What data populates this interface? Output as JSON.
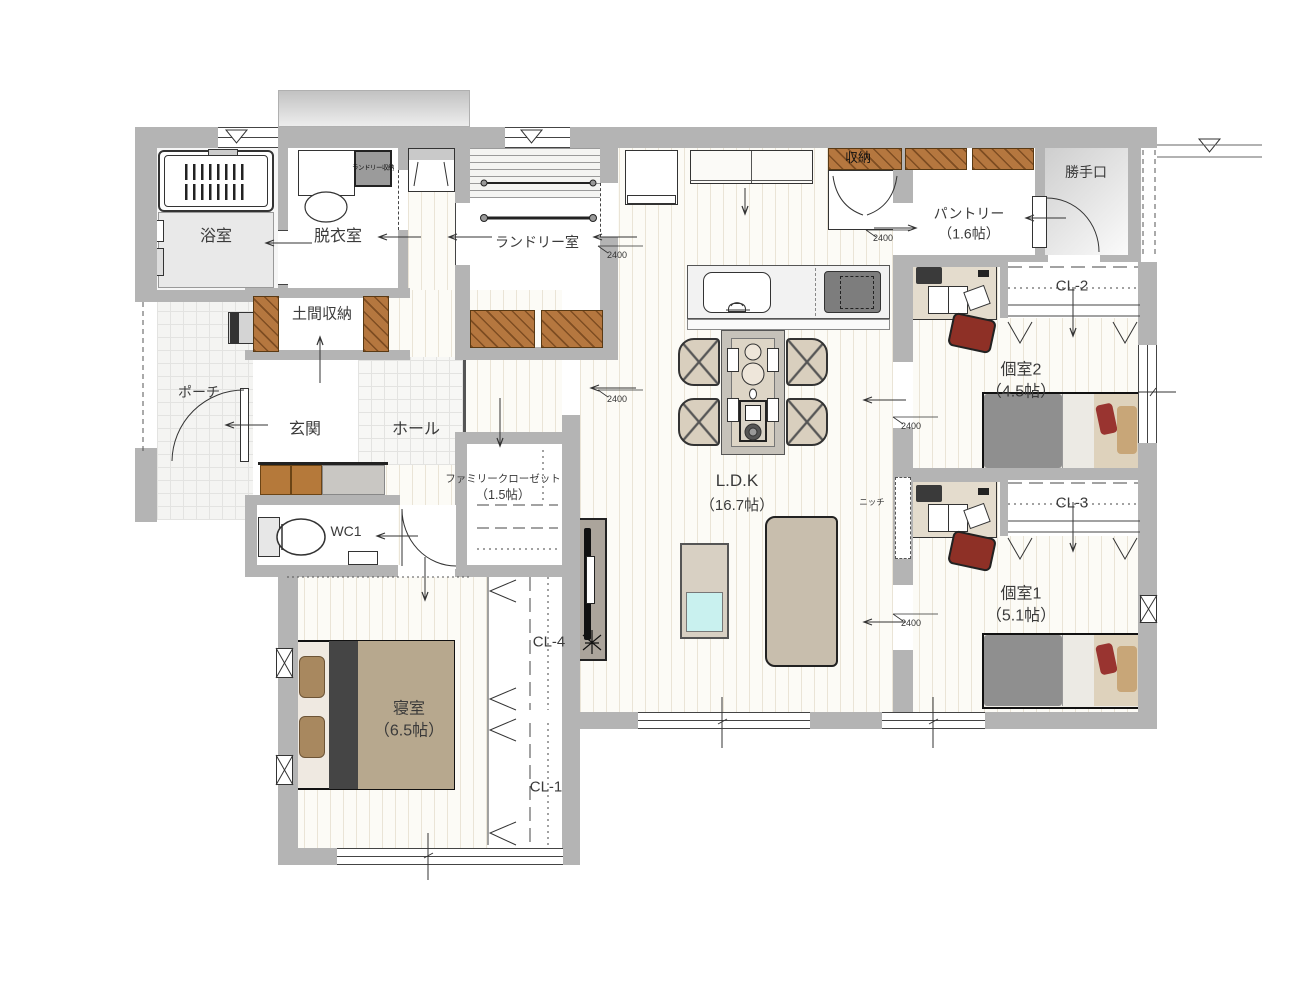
{
  "rooms": {
    "bath": "浴室",
    "dressing": "脱衣室",
    "laundry_storage": "ランドリー収納",
    "laundry": "ランドリー室",
    "storage_top": "収納",
    "pantry_name": "パントリー",
    "pantry_size": "（1.6帖）",
    "back_door": "勝手口",
    "cl2": "CL-2",
    "room2_name": "個室2",
    "room2_size": "（4.5帖）",
    "cl3": "CL-3",
    "room1_name": "個室1",
    "room1_size": "（5.1帖）",
    "doma_storage": "土間収納",
    "porch": "ポーチ",
    "entrance": "玄関",
    "hall": "ホール",
    "family_closet_name": "ファミリークローゼット",
    "family_closet_size": "（1.5帖）",
    "wc": "WC1",
    "ldk_name": "L.D.K",
    "ldk_size": "（16.7帖）",
    "niche": "ニッチ",
    "cl4": "CL-4",
    "cl1": "CL-1",
    "bedroom_name": "寝室",
    "bedroom_size": "（6.5帖）"
  },
  "dimensions": [
    "2400",
    "2400",
    "2400",
    "2400",
    "2400"
  ],
  "colors": {
    "wall": "#b4b4b4",
    "hatch_wood": "#b5773f",
    "bed_blanket": "#8f8f8f",
    "accent_red": "#8e3026",
    "tatami_beige": "#d9cfbe",
    "table_cyan": "#c9f1ef"
  }
}
